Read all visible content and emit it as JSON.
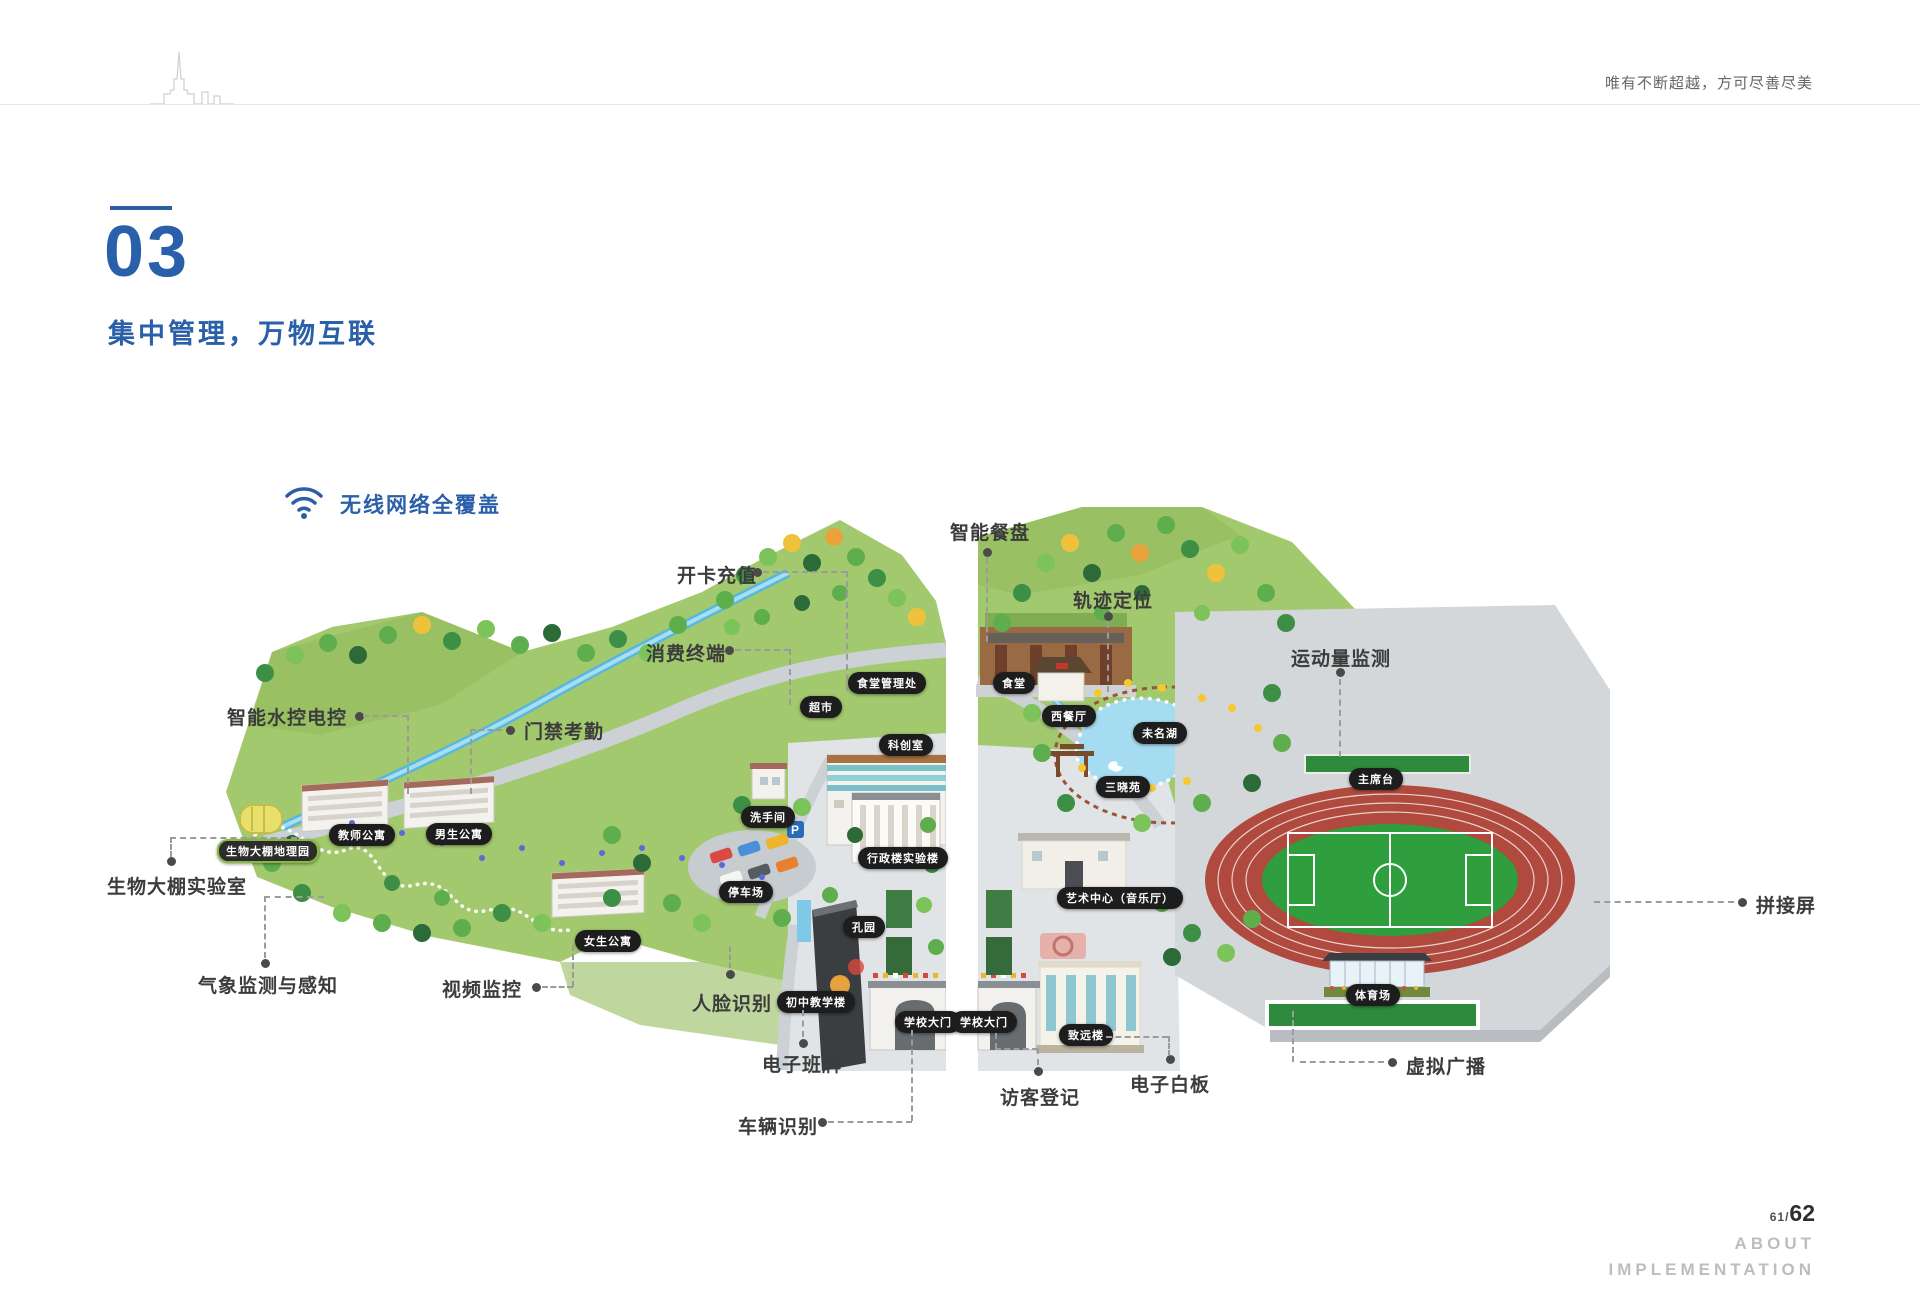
{
  "header": {
    "tagline": "唯有不断超越，方可尽善尽美"
  },
  "section": {
    "number": "03",
    "title": "集中管理，万物互联"
  },
  "wifi": {
    "label": "无线网络全覆盖"
  },
  "map": {
    "parking_sign": "P"
  },
  "callouts": [
    {
      "label": "智能水控电控"
    },
    {
      "label": "门禁考勤"
    },
    {
      "label": "生物大棚实验室"
    },
    {
      "label": "气象监测与感知"
    },
    {
      "label": "视频监控"
    },
    {
      "label": "人脸识别"
    },
    {
      "label": "电子班牌"
    },
    {
      "label": "车辆识别"
    },
    {
      "label": "开卡充值"
    },
    {
      "label": "消费终端"
    },
    {
      "label": "智能餐盘"
    },
    {
      "label": "轨迹定位"
    },
    {
      "label": "访客登记"
    },
    {
      "label": "电子白板"
    },
    {
      "label": "运动量监测"
    },
    {
      "label": "虚拟广播"
    },
    {
      "label": "拼接屏"
    }
  ],
  "map_badges": [
    {
      "label": "超市"
    },
    {
      "label": "食堂管理处"
    },
    {
      "label": "食堂"
    },
    {
      "label": "西餐厅"
    },
    {
      "label": "未名湖"
    },
    {
      "label": "三晓苑"
    },
    {
      "label": "科创室"
    },
    {
      "label": "洗手间"
    },
    {
      "label": "教师公寓"
    },
    {
      "label": "男生公寓"
    },
    {
      "label": "生物大棚地理园"
    },
    {
      "label": "停车场"
    },
    {
      "label": "行政楼实验楼"
    },
    {
      "label": "女生公寓"
    },
    {
      "label": "孔园"
    },
    {
      "label": "初中教学楼"
    },
    {
      "label": "学校大门"
    },
    {
      "label": "学校大门"
    },
    {
      "label": "艺术中心（音乐厅）"
    },
    {
      "label": "致远楼"
    },
    {
      "label": "主席台"
    },
    {
      "label": "体育场"
    }
  ],
  "footer": {
    "page_current": "61",
    "page_sep": "/",
    "page_total": "62",
    "about_line1": "ABOUT",
    "about_line2": "IMPLEMENTATION"
  },
  "colors": {
    "accent": "#2a5fa9",
    "dash_line": "#9b9b9b",
    "badge_bg": "#1d1d1d",
    "land_green": "#a3c96e",
    "water_blue": "#56b8de",
    "track_red": "#b04a3e",
    "field_green": "#2f9e3f"
  }
}
